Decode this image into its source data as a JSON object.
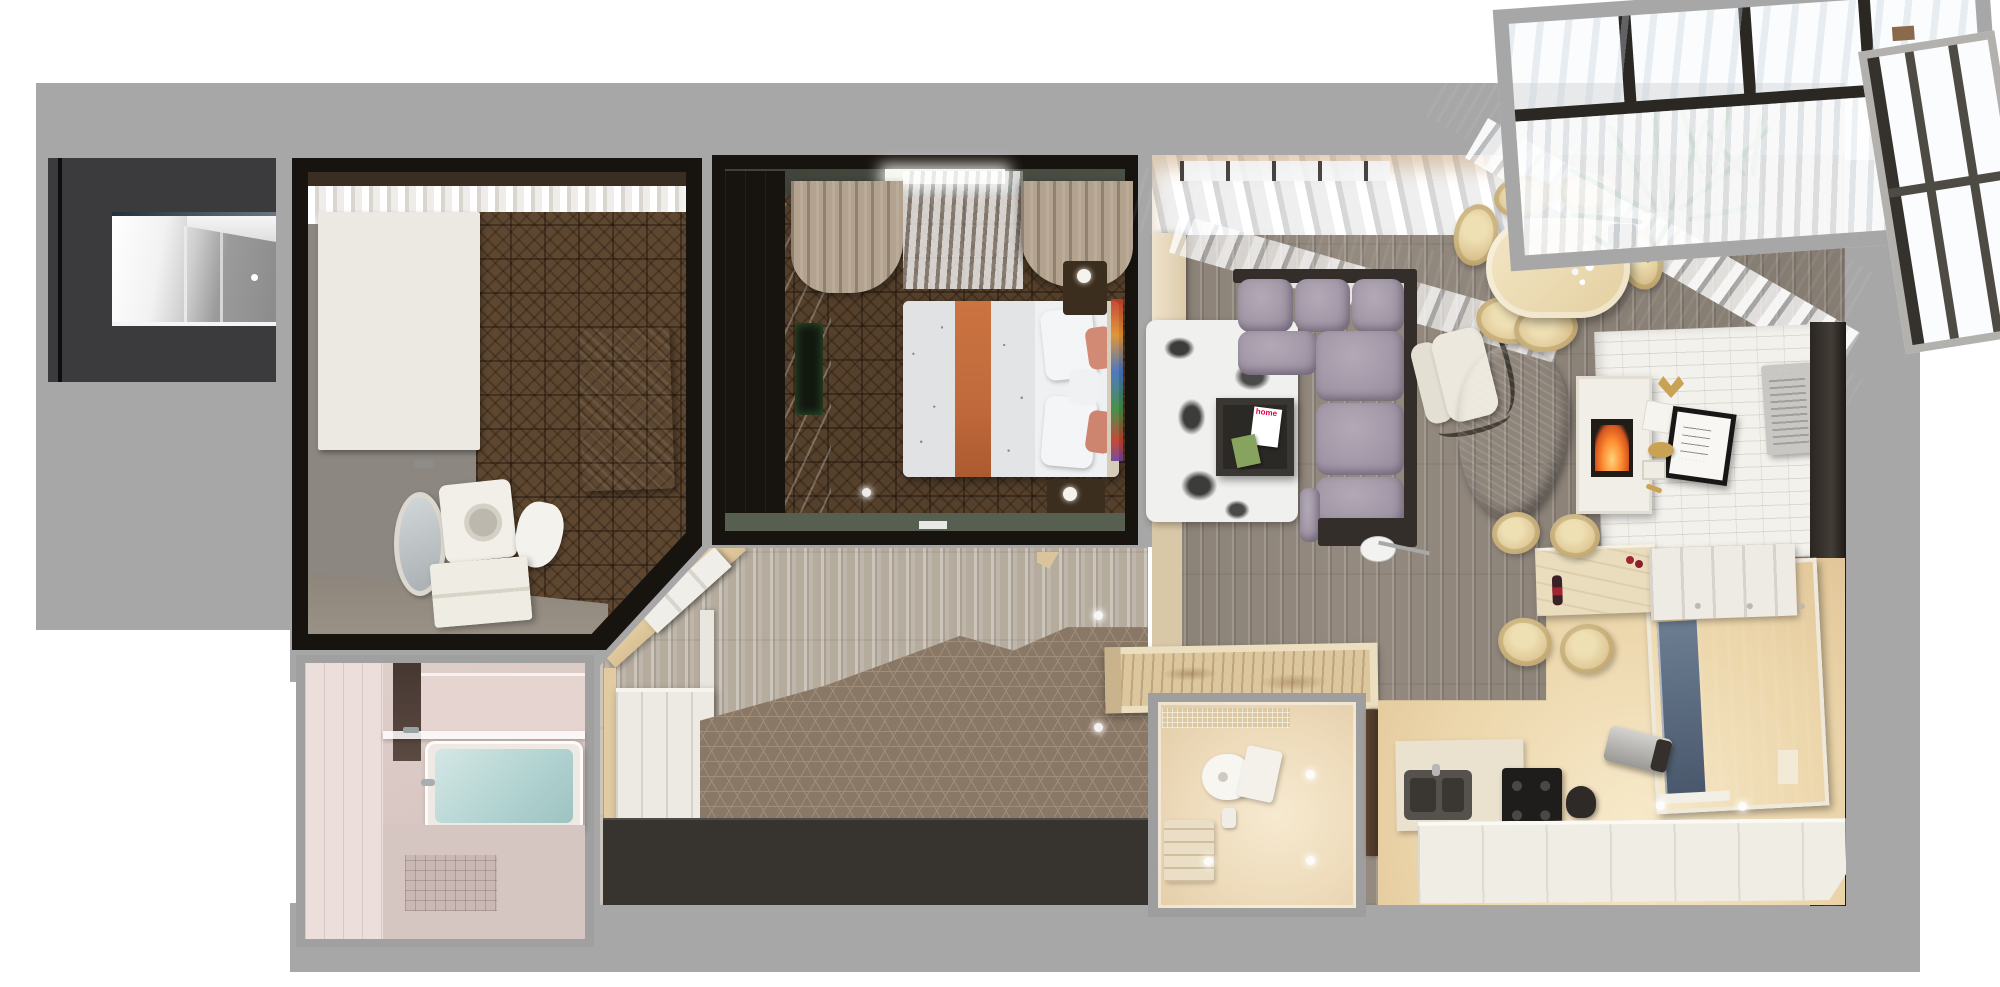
{
  "scene": {
    "type": "3d-rendered-apartment-floor-plan-top-view",
    "rooms": [
      {
        "label": "entry-hall"
      },
      {
        "label": "bathroom"
      },
      {
        "label": "shower-room"
      },
      {
        "label": "bedroom"
      },
      {
        "label": "hallway"
      },
      {
        "label": "wc"
      },
      {
        "label": "living-room"
      },
      {
        "label": "dining-area"
      },
      {
        "label": "kitchen"
      },
      {
        "label": "glazed-balcony"
      }
    ]
  },
  "magazine": {
    "title": "home"
  },
  "colors": {
    "page_bg": "#ffffff",
    "slab": "#a7a7a7",
    "wall_black": "#17130e",
    "entry_box": "#3b3b3d",
    "bath_wall": "#8d8781",
    "parquet_bath": "#5e4730",
    "parquet_bed": "#55402b",
    "towel": "#4e5f7d",
    "pink_wall": "#e0d0cc",
    "water": "#b0d2d0",
    "sage": "#576050",
    "drape": "#b3a38e",
    "runner": "#c0693c",
    "pillow_salmon": "#d28a74",
    "hall_plank": "#b5ac9e",
    "living_plank": "#948a7f",
    "hex": "#8a7866",
    "hex_line": "#a08d7a",
    "beige_wall": "#e2cba0",
    "mat": "#37332e",
    "wc_glow": "#f6e9cc",
    "sofa": "#9c92a2",
    "sofa_hi": "#b3a9b6",
    "sofa_frame": "#332e29",
    "chair": "#dcc492",
    "fur": "#7d7266",
    "brick": "#f3f1ec",
    "fire": "#ff8c30",
    "plum": "#2e2026",
    "plum2": "#3c2b33",
    "plant": "#4d8f46",
    "plant_dark": "#1f4a22",
    "kitchen_floor": "#ecd6ab",
    "counter_white": "#f0ede5",
    "gold": "#c9a253",
    "mullion": "#2b2824"
  }
}
